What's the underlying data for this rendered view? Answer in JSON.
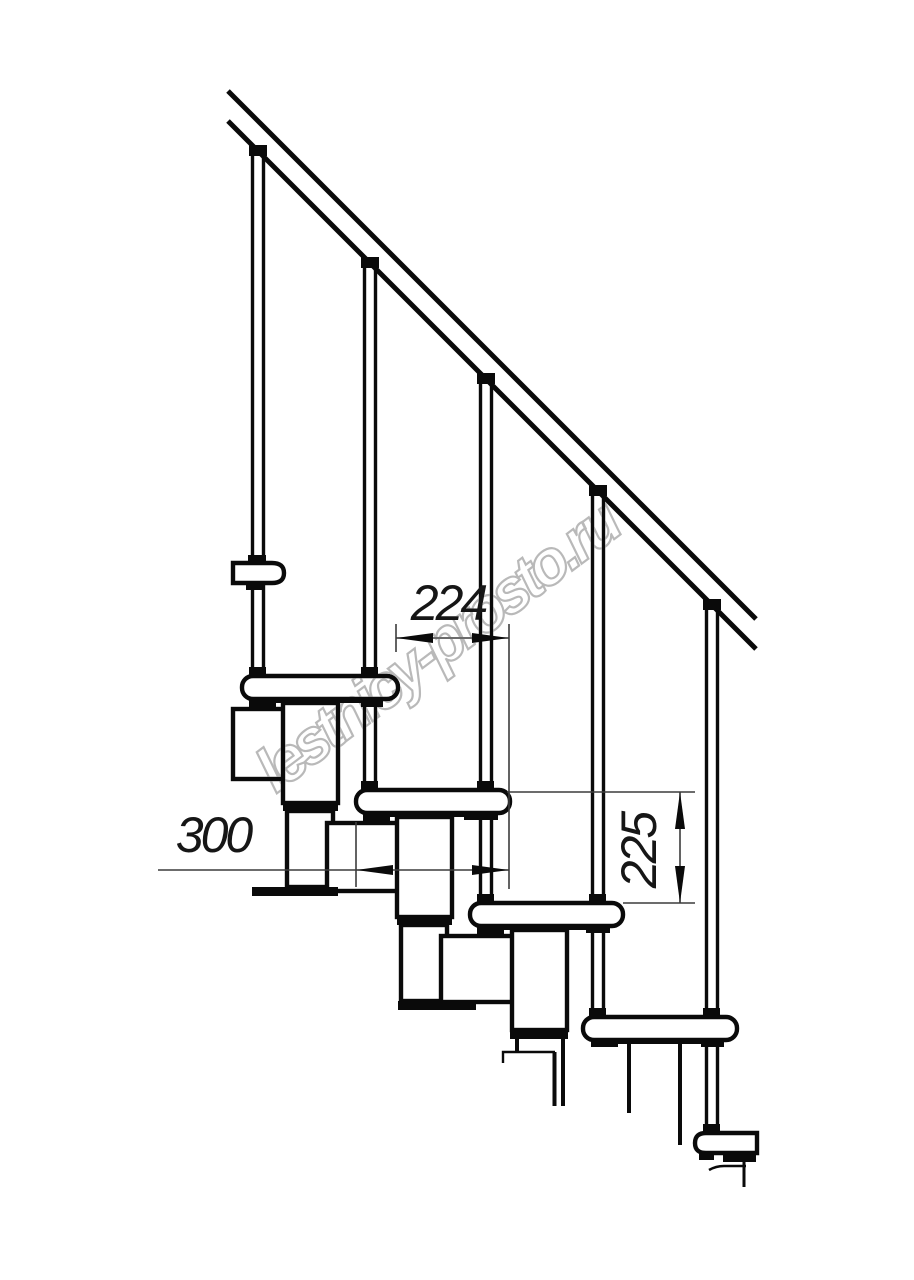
{
  "drawing": {
    "type": "technical-line-drawing",
    "subject": "modular staircase side elevation",
    "watermark_text": "lestnicy-prosto.ru",
    "colors": {
      "background": "#ffffff",
      "line": "#0a0a0a",
      "dimension_line": "#3c3c3c",
      "dimension_text": "#161616",
      "watermark": "#b2b2b2"
    },
    "dimensions": {
      "going": {
        "value": "224",
        "orientation": "horizontal"
      },
      "tread_depth": {
        "value": "300",
        "orientation": "horizontal"
      },
      "rise": {
        "value": "225",
        "orientation": "vertical"
      }
    }
  }
}
